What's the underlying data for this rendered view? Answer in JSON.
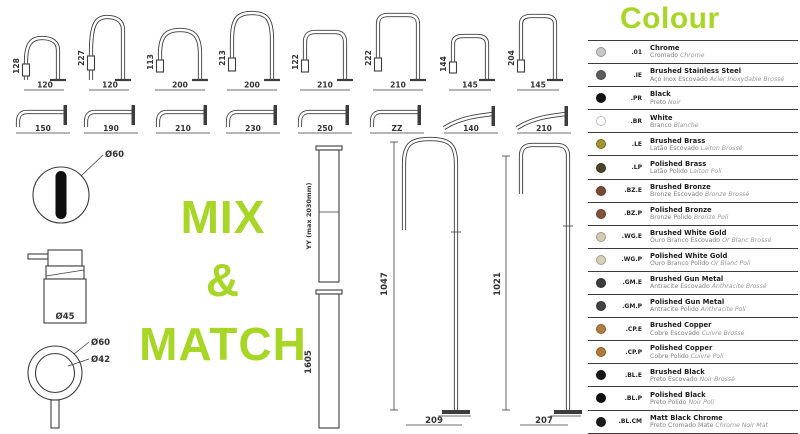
{
  "colors": {
    "accent": "#a8d626",
    "line": "#3d3d3d"
  },
  "mix_match": {
    "l1": "MIX",
    "l2": "&",
    "l3": "MATCH"
  },
  "top_spouts": [
    {
      "h": "128",
      "w": "120"
    },
    {
      "h": "227",
      "w": "120"
    },
    {
      "h": "113",
      "w": "200"
    },
    {
      "h": "213",
      "w": "200"
    },
    {
      "h": "122",
      "w": "210"
    },
    {
      "h": "222",
      "w": "210"
    },
    {
      "h": "144",
      "w": "145"
    },
    {
      "h": "204",
      "w": "145"
    }
  ],
  "wall_spouts": [
    "150",
    "190",
    "210",
    "230",
    "250",
    "ZZ",
    "140",
    "210"
  ],
  "left_items": {
    "sensor": "Ø60",
    "dispenser": "Ø45",
    "knob_outer": "Ø60",
    "knob_inner": "Ø42"
  },
  "risers": {
    "r1": "YY (max 2030mm)",
    "r2": "1605"
  },
  "floor_spouts": [
    {
      "h": "1047",
      "base": "209"
    },
    {
      "h": "1021",
      "base": "207"
    }
  ],
  "colour": {
    "title": "Colour",
    "items": [
      {
        "code": ".01",
        "name": "Chrome",
        "sub_a": "Cromado",
        "sub_b": "Chrome",
        "swatch": "#c8c8c8"
      },
      {
        "code": ".IE",
        "name": "Brushed Stainless Steel",
        "sub_a": "Aço Inox Escovado",
        "sub_b": "Acier Inoxydable Brossé",
        "swatch": "#5e5e5e"
      },
      {
        "code": ".PR",
        "name": "Black",
        "sub_a": "Preto",
        "sub_b": "Noir",
        "swatch": "#121212"
      },
      {
        "code": ".BR",
        "name": "White",
        "sub_a": "Branco",
        "sub_b": "Blanche",
        "swatch": "#ffffff"
      },
      {
        "code": ".LE",
        "name": "Brushed Brass",
        "sub_a": "Latão Escovado",
        "sub_b": "Laiton Brossé",
        "swatch": "#a3922d"
      },
      {
        "code": ".LP",
        "name": "Polished Brass",
        "sub_a": "Latão Polido",
        "sub_b": "Laiton Poli",
        "swatch": "#494327"
      },
      {
        "code": ".BZ.E",
        "name": "Brushed Bronze",
        "sub_a": "Bronze Escovado",
        "sub_b": "Bronze Brossé",
        "swatch": "#7b4a34"
      },
      {
        "code": ".BZ.P",
        "name": "Polished Bronze",
        "sub_a": "Bronze Polido",
        "sub_b": "Bronze Poli",
        "swatch": "#84523b"
      },
      {
        "code": ".WG.E",
        "name": "Brushed White Gold",
        "sub_a": "Ouro Branco Escovado",
        "sub_b": "Or Blanc Brossé",
        "swatch": "#d5ccb6"
      },
      {
        "code": ".WG.P",
        "name": "Polished White Gold",
        "sub_a": "Ouro Branco Polido",
        "sub_b": "Or Blanc Poli",
        "swatch": "#d8d0bc"
      },
      {
        "code": ".GM.E",
        "name": "Brushed Gun Metal",
        "sub_a": "Antracite Escovado",
        "sub_b": "Anthracite Brossé",
        "swatch": "#3d3d3d"
      },
      {
        "code": ".GM.P",
        "name": "Polished Gun Metal",
        "sub_a": "Antracite Polido",
        "sub_b": "Anthracite Poli",
        "swatch": "#424242"
      },
      {
        "code": ".CP.E",
        "name": "Brushed Copper",
        "sub_a": "Cobre Escovado",
        "sub_b": "Cuivre Brossé",
        "swatch": "#b17e41"
      },
      {
        "code": ".CP.P",
        "name": "Polished Copper",
        "sub_a": "Cobre Polido",
        "sub_b": "Cuivre Poli",
        "swatch": "#b37936"
      },
      {
        "code": ".BL.E",
        "name": "Brushed Black",
        "sub_a": "Preto Escovado",
        "sub_b": "Noir Brossé",
        "swatch": "#161616"
      },
      {
        "code": ".BL.P",
        "name": "Polished Black",
        "sub_a": "Preto Polido",
        "sub_b": "Noir Poli",
        "swatch": "#0f0f0f"
      },
      {
        "code": ".BL.CM",
        "name": "Matt Black Chrome",
        "sub_a": "Preto Cromado Mate",
        "sub_b": "Chrome Noir Mat",
        "swatch": "#1b1b1b"
      }
    ]
  }
}
